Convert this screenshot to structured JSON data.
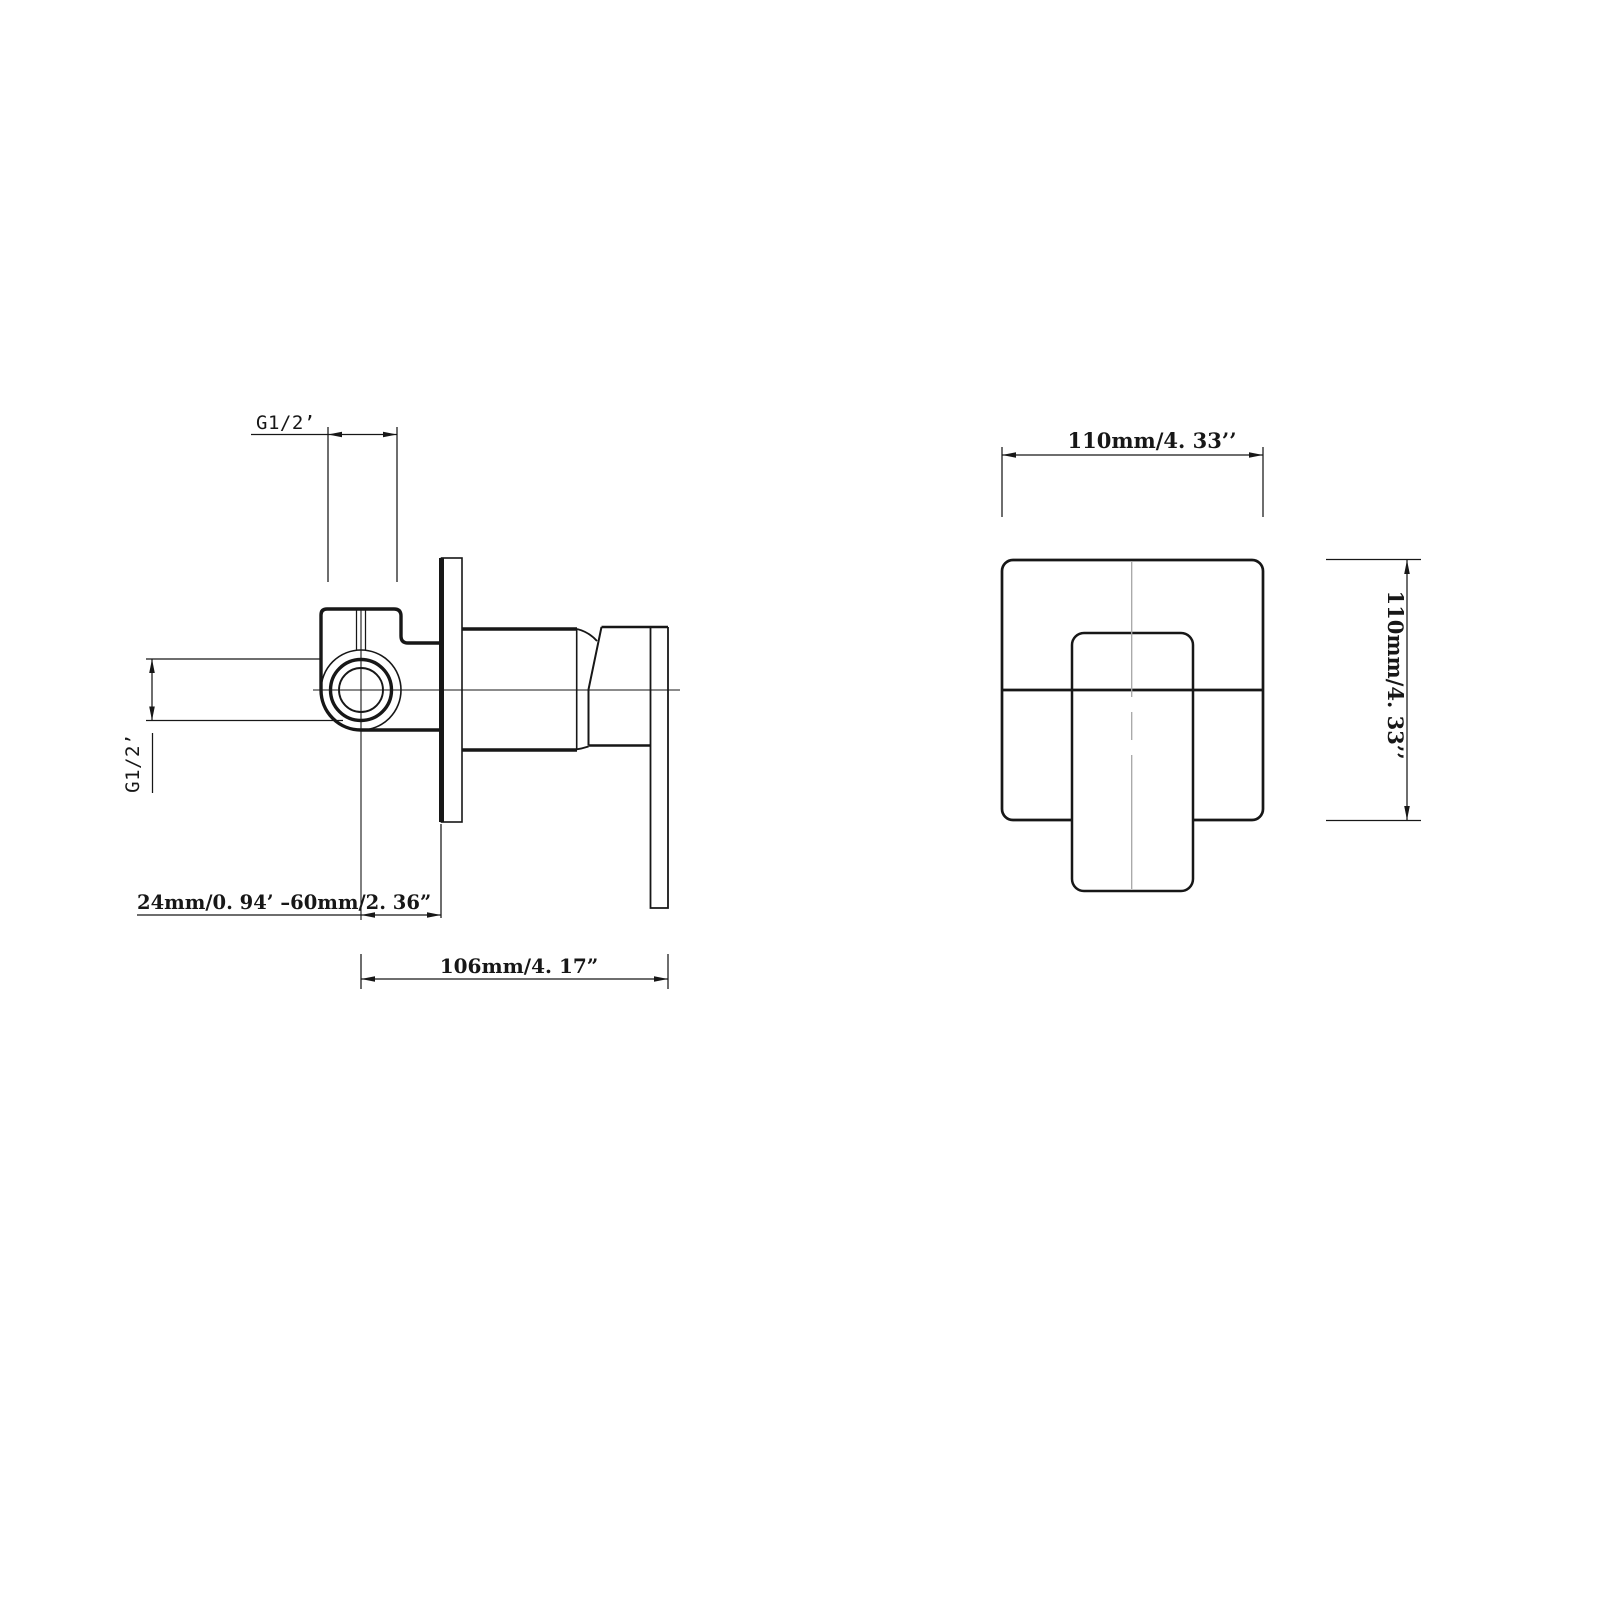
{
  "page": {
    "background": "#ffffff",
    "ink_color": "#171717",
    "centerline_color": "#a6a6a6"
  },
  "drawing": {
    "side_view": {
      "top_port_thread": "G1/2’",
      "side_port_thread": "G1/2’",
      "install_depth_range": "24mm/0. 94’ –60mm/2. 36”",
      "overall_depth": "106mm/4. 17”"
    },
    "front_view": {
      "plate_width": "110mm/4. 33’’",
      "plate_height": "110mm/4. 33’’"
    }
  }
}
